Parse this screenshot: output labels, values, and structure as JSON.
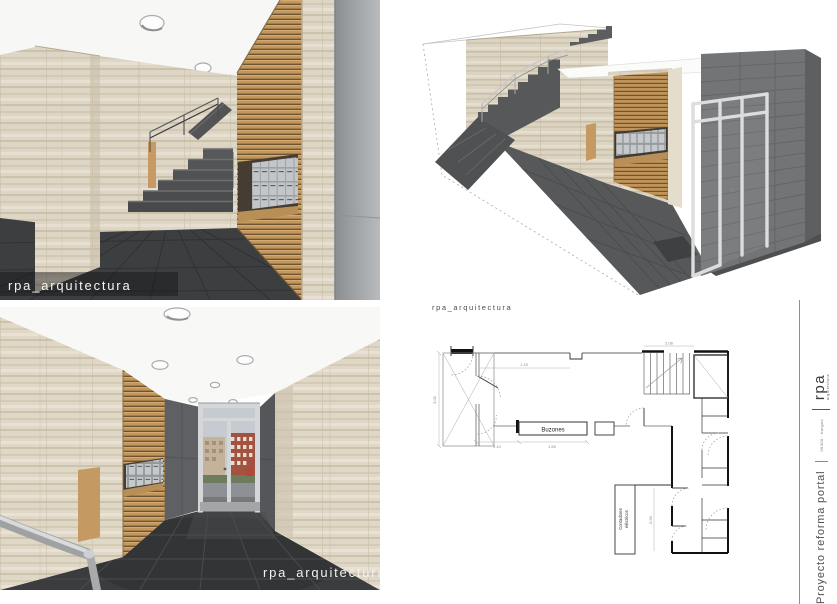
{
  "renders": {
    "hall_stairs": {
      "watermark": "rpa_arquitectura"
    },
    "hall_entrance": {
      "watermark": "rpa_arquitectura"
    },
    "axonometric": {
      "caption": "rpa_arquitectura"
    }
  },
  "plan": {
    "labels": {
      "mailboxes": "Buzones",
      "meter_line1": "Contadores",
      "meter_line2": "eléctricos"
    },
    "dims": {
      "left": "3.00",
      "vestibule": "2.10",
      "hall": "1.15",
      "mailboxes": "1.55",
      "stairs": "2.08",
      "room": "0.90"
    }
  },
  "titleblock": {
    "project": "Proyecto reforma portal",
    "details": "09400 · burgos",
    "brand": "rpa",
    "brand_subtitle": "arquitectura"
  },
  "colors": {
    "travertine": "#ddd5c4",
    "wood": "#c3965c",
    "floor_dark": "#3d3e40",
    "wall_gray": "#737476",
    "text_gray": "#4f4f4f"
  }
}
